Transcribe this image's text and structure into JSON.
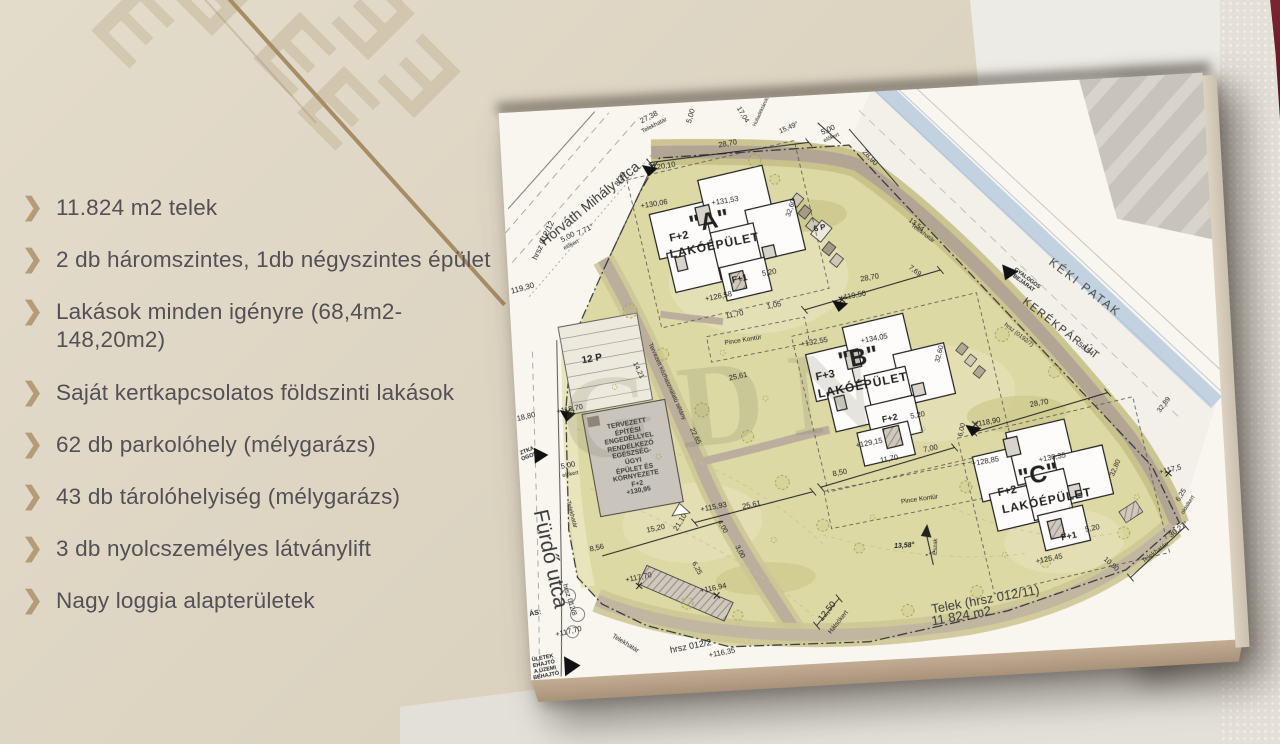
{
  "background": {
    "wall_color": "#ddd4c2",
    "pattern_glyph": "E",
    "accent_line_color": "#a78d64"
  },
  "feature_list": {
    "bullet_glyph": "❯",
    "bullet_color": "#b59c76",
    "text_color": "#515156",
    "items": [
      "11.824 m2 telek",
      "2 db háromszintes, 1db négyszintes épület",
      "Lakások minden igényre (68,4m2-148,20m2)",
      "Saját kertkapcsolatos földszinti lakások",
      "62 db parkolóhely (mélygarázs)",
      "43 db tárolóhelyiség (mélygarázs)",
      "3 db nyolcszemélyes látványlift",
      "Nagy loggia alapterületek"
    ]
  },
  "site_plan": {
    "watermark": "GDN",
    "paper_color": "#f8f6ef",
    "area_color": "#dcd9a5",
    "stream_color": "#c3d2e0",
    "path_color": "#b2a593",
    "parcel_note_line1": "Telek (hrsz 012/11)",
    "parcel_note_line2": "11 824 m2",
    "labels": [
      {
        "t": "Horváth Mihály utca",
        "x": 86,
        "y": 96,
        "r": -36,
        "s": 14,
        "c": "#3a3a3a"
      },
      {
        "t": "hrsz 012/12",
        "x": 38,
        "y": 130,
        "r": -62,
        "s": 8
      },
      {
        "t": "119,30",
        "x": 14,
        "y": 177,
        "r": -12,
        "s": 8
      },
      {
        "t": "27,38",
        "x": 150,
        "y": 13,
        "r": -24,
        "s": 7.5
      },
      {
        "t": "Telekhatár",
        "x": 155,
        "y": 22,
        "r": -24,
        "s": 6
      },
      {
        "t": "7,71°",
        "x": 80,
        "y": 122,
        "r": -24,
        "s": 7.5
      },
      {
        "t": "8,20",
        "x": 118,
        "y": 73,
        "r": -56,
        "s": 7.5
      },
      {
        "t": "5,00",
        "x": 62,
        "y": 128,
        "r": -24,
        "s": 7.5
      },
      {
        "t": "előkert",
        "x": 65,
        "y": 136,
        "r": -24,
        "s": 5.5
      },
      {
        "t": "+120,10",
        "x": 160,
        "y": 63,
        "r": -6,
        "s": 7.5
      },
      {
        "t": "5,00",
        "x": 192,
        "y": 14,
        "r": -70,
        "s": 7.5
      },
      {
        "t": "28,70",
        "x": 227,
        "y": 44,
        "r": -7,
        "s": 7.5
      },
      {
        "t": "17,04",
        "x": 243,
        "y": 16,
        "r": 62,
        "s": 7
      },
      {
        "t": "Hulladéktároló",
        "x": 263,
        "y": 14,
        "r": -62,
        "s": 5
      },
      {
        "t": "15,49°",
        "x": 289,
        "y": 32,
        "r": -20,
        "s": 7
      },
      {
        "t": "5,00",
        "x": 328,
        "y": 36,
        "r": -20,
        "s": 7.5
      },
      {
        "t": "előkert",
        "x": 331,
        "y": 44,
        "r": -20,
        "s": 5.5
      },
      {
        "t": "28,90",
        "x": 368,
        "y": 66,
        "r": 50,
        "s": 7.5
      },
      {
        "t": "+130,06",
        "x": 150,
        "y": 100,
        "r": -6,
        "s": 7.5
      },
      {
        "t": "+131,53",
        "x": 221,
        "y": 101,
        "r": -6,
        "s": 7.5
      },
      {
        "t": "\"A\"",
        "x": 204,
        "y": 121,
        "r": -8,
        "s": 24,
        "w": 700
      },
      {
        "t": "F+2",
        "x": 173,
        "y": 134,
        "r": -8,
        "s": 11,
        "w": 700
      },
      {
        "t": "LAKÓÉPÜLET",
        "x": 208,
        "y": 145,
        "r": -8,
        "s": 12,
        "w": 700,
        "ls": 1
      },
      {
        "t": "F+1",
        "x": 231,
        "y": 179,
        "r": -8,
        "s": 9,
        "w": 700
      },
      {
        "t": "+126,58",
        "x": 209,
        "y": 196,
        "r": -8,
        "s": 7.5
      },
      {
        "t": "5,20",
        "x": 261,
        "y": 175,
        "r": -8,
        "s": 7.5
      },
      {
        "t": "11,70",
        "x": 224,
        "y": 215,
        "r": -8,
        "s": 7.5
      },
      {
        "t": "1,05",
        "x": 264,
        "y": 208,
        "r": -8,
        "s": 7.5
      },
      {
        "t": "Pince Kontúr",
        "x": 231,
        "y": 241,
        "r": -6,
        "s": 6.5
      },
      {
        "t": "6 P",
        "x": 314,
        "y": 134,
        "r": -8,
        "s": 8,
        "w": 700
      },
      {
        "t": "32,60",
        "x": 287,
        "y": 112,
        "r": -68,
        "s": 7
      },
      {
        "t": "13,54",
        "x": 410,
        "y": 136,
        "r": 40,
        "s": 7
      },
      {
        "t": "Telekhatár",
        "x": 416,
        "y": 145,
        "r": 40,
        "s": 6
      },
      {
        "t": "7,69",
        "x": 406,
        "y": 182,
        "r": 40,
        "s": 7
      },
      {
        "t": "GYALOGOS\nBEJÁRAT",
        "x": 516,
        "y": 198,
        "r": 40,
        "s": 5.5,
        "w": 700
      },
      {
        "t": "KÉKI PATAK",
        "x": 575,
        "y": 208,
        "r": 41,
        "s": 12,
        "ls": 2,
        "c": "#4a4a4a"
      },
      {
        "t": "KERÉKPÁR ÚT",
        "x": 549,
        "y": 248,
        "r": 41,
        "s": 11,
        "ls": 1.5,
        "c": "#333333"
      },
      {
        "t": "hrsz (0192/7)",
        "x": 506,
        "y": 252,
        "r": 41,
        "s": 6
      },
      {
        "t": "58,54",
        "x": 572,
        "y": 270,
        "r": 41,
        "s": 7
      },
      {
        "t": "+119,50",
        "x": 343,
        "y": 203,
        "r": -7,
        "s": 7.5
      },
      {
        "t": "28,70",
        "x": 361,
        "y": 186,
        "r": -7,
        "s": 7.5
      },
      {
        "t": "+132,55",
        "x": 302,
        "y": 247,
        "r": -7,
        "s": 7.5
      },
      {
        "t": "+134,05",
        "x": 362,
        "y": 247,
        "r": -7,
        "s": 7.5
      },
      {
        "t": "\"B\"",
        "x": 345,
        "y": 266,
        "r": -8,
        "s": 24,
        "w": 700
      },
      {
        "t": "F+3",
        "x": 311,
        "y": 281,
        "r": -8,
        "s": 11,
        "w": 700
      },
      {
        "t": "LAKÓÉPÜLET",
        "x": 348,
        "y": 293,
        "r": -8,
        "s": 12,
        "w": 700,
        "ls": 1
      },
      {
        "t": "F+2",
        "x": 373,
        "y": 327,
        "r": -8,
        "s": 9,
        "w": 700
      },
      {
        "t": "+129,15",
        "x": 351,
        "y": 351,
        "r": -8,
        "s": 7.5
      },
      {
        "t": "5,20",
        "x": 401,
        "y": 326,
        "r": -8,
        "s": 7.5
      },
      {
        "t": "25,61",
        "x": 224,
        "y": 277,
        "r": -8,
        "s": 7.5
      },
      {
        "t": "32,60",
        "x": 427,
        "y": 266,
        "r": -72,
        "s": 7
      },
      {
        "t": "14,21",
        "x": 124,
        "y": 265,
        "r": 68,
        "s": 7
      },
      {
        "t": "22,65",
        "x": 177,
        "y": 334,
        "r": 68,
        "s": 7
      },
      {
        "t": "Tervezett közhasználatú sétány",
        "x": 152,
        "y": 278,
        "r": 69,
        "s": 6
      },
      {
        "t": "12 P",
        "x": 79,
        "y": 251,
        "r": -7,
        "s": 10,
        "w": 700
      },
      {
        "t": "18,80",
        "x": 10,
        "y": 305,
        "r": -10,
        "s": 7.5
      },
      {
        "t": "+118,70",
        "x": 54,
        "y": 300,
        "r": -8,
        "s": 7.5
      },
      {
        "t": "TERVEZETT\nÉPÍTÉSI\nENGEDÉLLYEL\nRENDELKEZŐ\nEGÉSZSÉG-\nÜGYI\nÉPÜLET ÉS\nKÖRNYEZETE\nF+2\n+130,95",
        "x": 114,
        "y": 352,
        "r": -7,
        "s": 6.8,
        "w": 700,
        "c": "#3c3c3c"
      },
      {
        "t": "5,00",
        "x": 49,
        "y": 356,
        "r": -8,
        "s": 7.5
      },
      {
        "t": "előkert",
        "x": 51,
        "y": 365,
        "r": -8,
        "s": 5.5
      },
      {
        "t": "ZTKA\nOGOS",
        "x": 10,
        "y": 342,
        "r": -18,
        "s": 5.5,
        "w": 700
      },
      {
        "t": "Telekhatár",
        "x": 49,
        "y": 405,
        "r": 78,
        "s": 6
      },
      {
        "t": "Fürdő utca",
        "x": 26,
        "y": 448,
        "r": 81,
        "s": 21,
        "c": "#3a3a3a"
      },
      {
        "t": "hrsz 012/8",
        "x": 42,
        "y": 490,
        "r": 76,
        "s": 7
      },
      {
        "t": "ÁS:",
        "x": 8,
        "y": 502,
        "r": -8,
        "s": 7,
        "w": 700
      },
      {
        "t": "ÜLETEK\nEHAJTÓ\nA ÜZEMI\nBEHAJTÓ",
        "x": 14,
        "y": 556,
        "r": -8,
        "s": 5.5,
        "w": 700
      },
      {
        "t": "+117,70",
        "x": 40,
        "y": 522,
        "r": -10,
        "s": 7.5
      },
      {
        "t": "8,56",
        "x": 73,
        "y": 440,
        "r": -9,
        "s": 7.5
      },
      {
        "t": "Telekhatár",
        "x": 96,
        "y": 537,
        "r": 35,
        "s": 6.5
      },
      {
        "t": "15,20",
        "x": 133,
        "y": 424,
        "r": -9,
        "s": 7.5
      },
      {
        "t": "21,10",
        "x": 158,
        "y": 419,
        "r": -55,
        "s": 7.5
      },
      {
        "t": "+117,70",
        "x": 113,
        "y": 472,
        "r": -8,
        "s": 7.5
      },
      {
        "t": "+115,93",
        "x": 192,
        "y": 406,
        "r": -8,
        "s": 7.5
      },
      {
        "t": "25,61",
        "x": 230,
        "y": 406,
        "r": -9,
        "s": 7.5
      },
      {
        "t": "4,00",
        "x": 199,
        "y": 426,
        "r": 65,
        "s": 7
      },
      {
        "t": "3,00",
        "x": 215,
        "y": 452,
        "r": 65,
        "s": 7
      },
      {
        "t": "6,25",
        "x": 171,
        "y": 466,
        "r": 65,
        "s": 7
      },
      {
        "t": "+116,94",
        "x": 187,
        "y": 487,
        "r": -8,
        "s": 7.5
      },
      {
        "t": "hrsz 012/2",
        "x": 161,
        "y": 543,
        "r": -8,
        "s": 9
      },
      {
        "t": "+116,35",
        "x": 192,
        "y": 552,
        "r": -8,
        "s": 7.5
      },
      {
        "t": "12,50",
        "x": 299,
        "y": 516,
        "r": -48,
        "s": 9
      },
      {
        "t": "Hátsókert",
        "x": 310,
        "y": 528,
        "r": -48,
        "s": 6.5
      },
      {
        "t": "Pince Kontúr",
        "x": 398,
        "y": 410,
        "r": -5,
        "s": 6.5
      },
      {
        "t": "8,50",
        "x": 320,
        "y": 379,
        "r": -8,
        "s": 7.5
      },
      {
        "t": "11,70",
        "x": 370,
        "y": 368,
        "r": -8,
        "s": 7.5
      },
      {
        "t": "7,00",
        "x": 412,
        "y": 360,
        "r": -8,
        "s": 7.5
      },
      {
        "t": "6,00",
        "x": 445,
        "y": 343,
        "r": -74,
        "s": 7
      },
      {
        "t": "13,58°",
        "x": 380,
        "y": 456,
        "r": 0,
        "s": 7,
        "w": 700,
        "i": 1
      },
      {
        "t": "Észak",
        "x": 412,
        "y": 458,
        "r": -85,
        "s": 6
      },
      {
        "t": "Telek (hrsz 012/11)",
        "x": 458,
        "y": 514,
        "r": -7,
        "s": 13,
        "c": "#3a3a3a"
      },
      {
        "t": "11 824 m2",
        "x": 433,
        "y": 529,
        "r": -7,
        "s": 13,
        "c": "#3a3a3a"
      },
      {
        "t": "+118,90",
        "x": 470,
        "y": 337,
        "r": -7,
        "s": 7.5
      },
      {
        "t": "28,70",
        "x": 523,
        "y": 321,
        "r": -7,
        "s": 7.5
      },
      {
        "t": "+128,85",
        "x": 466,
        "y": 376,
        "r": -7,
        "s": 7.5
      },
      {
        "t": "+130,35",
        "x": 533,
        "y": 376,
        "r": -7,
        "s": 7.5
      },
      {
        "t": "\"C\"",
        "x": 518,
        "y": 393,
        "r": -8,
        "s": 24,
        "w": 700
      },
      {
        "t": "F+2",
        "x": 486,
        "y": 407,
        "r": -8,
        "s": 11,
        "w": 700
      },
      {
        "t": "LAKÓÉPÜLET",
        "x": 525,
        "y": 419,
        "r": -8,
        "s": 12,
        "w": 700,
        "ls": 1
      },
      {
        "t": "F+1",
        "x": 545,
        "y": 455,
        "r": -8,
        "s": 9,
        "w": 700
      },
      {
        "t": "+125,45",
        "x": 524,
        "y": 477,
        "r": -8,
        "s": 7.5
      },
      {
        "t": "5,20",
        "x": 569,
        "y": 449,
        "r": -8,
        "s": 7.5
      },
      {
        "t": "32,80",
        "x": 596,
        "y": 390,
        "r": -64,
        "s": 7
      },
      {
        "t": "32,89",
        "x": 648,
        "y": 330,
        "r": -50,
        "s": 7
      },
      {
        "t": "+117,5",
        "x": 650,
        "y": 395,
        "r": -10,
        "s": 7.5
      },
      {
        "t": "6,25",
        "x": 660,
        "y": 421,
        "r": -55,
        "s": 7
      },
      {
        "t": "oldalkert",
        "x": 666,
        "y": 431,
        "r": -55,
        "s": 5.5
      },
      {
        "t": "10,80",
        "x": 585,
        "y": 486,
        "r": 45,
        "s": 7
      },
      {
        "t": "Telekhatár",
        "x": 630,
        "y": 477,
        "r": -33,
        "s": 6.5
      },
      {
        "t": "30,27°",
        "x": 655,
        "y": 455,
        "r": -33,
        "s": 7.5
      }
    ]
  }
}
